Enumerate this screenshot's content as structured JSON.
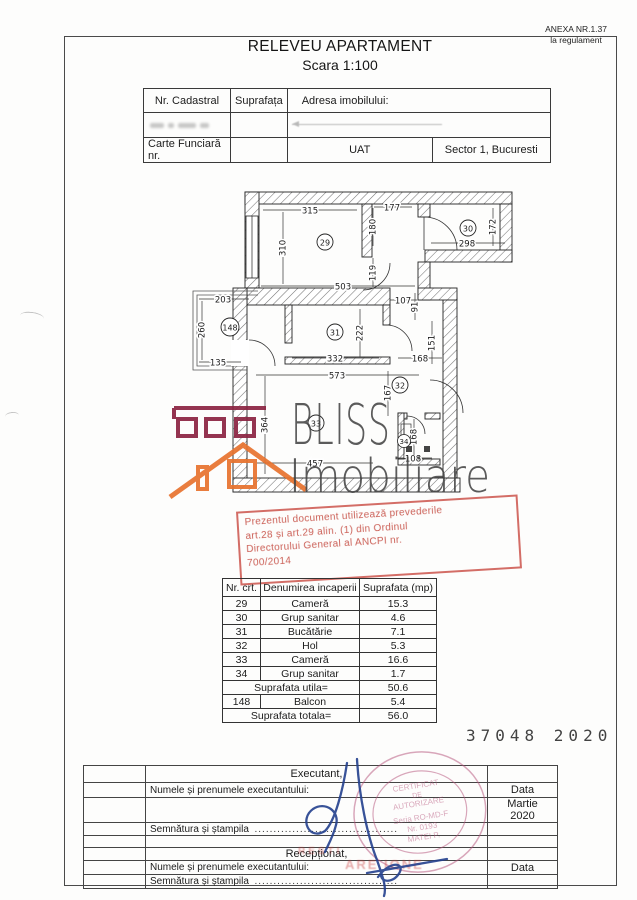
{
  "page": {
    "anexa_line1": "ANEXA NR.1.37",
    "anexa_line2": "la regulament",
    "title": "RELEVEU APARTAMENT",
    "subtitle": "Scara 1:100"
  },
  "info_table": {
    "col1_header": "Nr. Cadastral",
    "col2_header": "Suprafața",
    "col3_header": "Adresa imobilului:",
    "row3_col1": "Carte Funciară nr.",
    "row3_uat": "UAT",
    "row3_sector": "Sector 1, Bucuresti"
  },
  "plan": {
    "rooms": [
      "29",
      "30",
      "31",
      "32",
      "33",
      "34",
      "148"
    ],
    "dims": [
      "315",
      "177",
      "310",
      "180",
      "298",
      "172",
      "119",
      "503",
      "107",
      "91",
      "203",
      "260",
      "135",
      "332",
      "222",
      "168",
      "151",
      "573",
      "167",
      "364",
      "457",
      "108",
      "168"
    ]
  },
  "watermark": {
    "line1": "BLISS",
    "line2": "Imobiliare"
  },
  "stamp_red": {
    "line1": "Prezentul document utilizează prevederile",
    "line2": "art.28 și art.29 alin. (1) din Ordinul",
    "line3": "Directorului General al ANCPI nr.",
    "line4": "700/2014"
  },
  "room_table": {
    "headers": [
      "Nr. crt.",
      "Denumirea incaperii",
      "Suprafata (mp)"
    ],
    "rows": [
      [
        "29",
        "Cameră",
        "15.3"
      ],
      [
        "30",
        "Grup sanitar",
        "4.6"
      ],
      [
        "31",
        "Bucătărie",
        "7.1"
      ],
      [
        "32",
        "Hol",
        "5.3"
      ],
      [
        "33",
        "Cameră",
        "16.6"
      ],
      [
        "34",
        "Grup sanitar",
        "1.7"
      ]
    ],
    "util_label": "Suprafata utila=",
    "util_value": "50.6",
    "balcony_row": [
      "148",
      "Balcon",
      "5.4"
    ],
    "total_label": "Suprafata totala=",
    "total_value": "56.0"
  },
  "registration_number": "37048 2020",
  "signature_table": {
    "executant_label": "Executant,",
    "name_label": "Numele și prenumele executantului:",
    "data_label": "Data",
    "date_line1": "Martie",
    "date_line2": "2020",
    "signature_label": "Semnătura și ștampila",
    "dots": "......................................",
    "receptionat_label": "Recepționat,",
    "name_label2": "Numele și prenumele executantului:",
    "data_label2": "Data"
  },
  "round_stamp": {
    "line1": "CERTIFICAT",
    "line2": "DE",
    "line3": "AUTORIZARE",
    "line4": "Seria RO-MD-F",
    "line5": "Nr. 0193",
    "line6": "MATEI P."
  },
  "stamp_fragments": {
    "frag1": "RESTI",
    "frag2": "ARE IONE"
  },
  "colors": {
    "stamp_red": "#c63e34",
    "round_stamp_pink": "#b5527a",
    "logo_darkred": "#8c2442",
    "logo_orange": "#e8732e",
    "signature_blue": "#23408e",
    "watermark_gray": "#454545"
  }
}
